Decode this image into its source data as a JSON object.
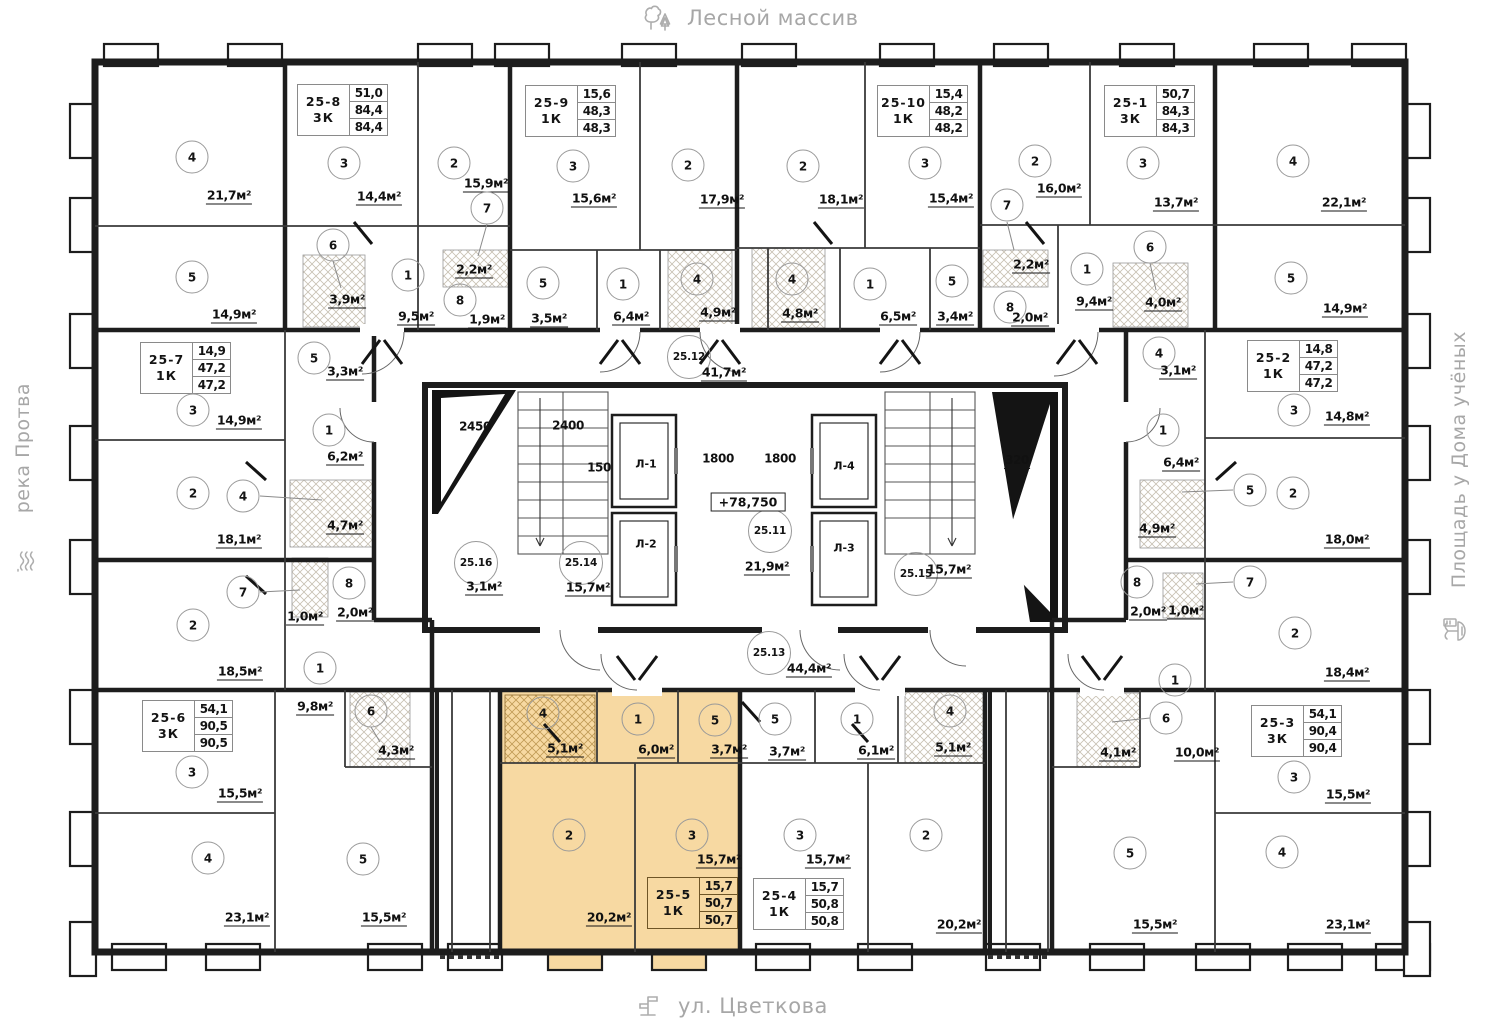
{
  "surroundings": {
    "top": {
      "label": "Лесной массив",
      "icon": "trees-icon"
    },
    "bottom": {
      "label": "ул. Цветкова",
      "icon": "street-sign-icon"
    },
    "left": {
      "label": "река Протва",
      "icon": "river-waves-icon"
    },
    "right": {
      "label": "Площадь у Дома учёных",
      "icon": "fountain-icon"
    }
  },
  "colors": {
    "highlight": "#f7d9a2",
    "wall": "#1d1d1d",
    "decor_text": "#a7a7a7"
  },
  "units": [
    {
      "id": "25-8",
      "type": "3К",
      "vals": [
        "51,0",
        "84,4",
        "84,4"
      ],
      "box": [
        297,
        84
      ],
      "rooms": [
        {
          "n": "4",
          "c": [
            192,
            157
          ],
          "a": "21,7м²",
          "ap": [
            229,
            196
          ]
        },
        {
          "n": "3",
          "c": [
            344,
            163
          ],
          "a": "14,4м²",
          "ap": [
            379,
            197
          ]
        },
        {
          "n": "2",
          "c": [
            454,
            163
          ],
          "a": "15,9м²",
          "ap": [
            486,
            184
          ]
        },
        {
          "n": "7",
          "c": [
            487,
            208
          ],
          "a": "2,2м²",
          "ap": [
            474,
            270
          ],
          "leader": [
            487,
            224,
            478,
            256
          ]
        },
        {
          "n": "6",
          "c": [
            333,
            245
          ],
          "a": "3,9м²",
          "ap": [
            347,
            300
          ],
          "leader": [
            333,
            261,
            341,
            288
          ]
        },
        {
          "n": "5",
          "c": [
            192,
            277
          ],
          "a": "14,9м²",
          "ap": [
            234,
            315
          ]
        },
        {
          "n": "1",
          "c": [
            408,
            275
          ],
          "a": "9,5м²",
          "ap": [
            416,
            317
          ]
        },
        {
          "n": "8",
          "c": [
            460,
            300
          ],
          "a": "1,9м²",
          "ap": [
            487,
            320
          ]
        }
      ]
    },
    {
      "id": "25-9",
      "type": "1К",
      "vals": [
        "15,6",
        "48,3",
        "48,3"
      ],
      "box": [
        525,
        85
      ],
      "rooms": [
        {
          "n": "3",
          "c": [
            573,
            166
          ],
          "a": "15,6м²",
          "ap": [
            594,
            199
          ]
        },
        {
          "n": "2",
          "c": [
            688,
            165
          ],
          "a": "17,9м²",
          "ap": [
            722,
            200
          ]
        },
        {
          "n": "5",
          "c": [
            543,
            283
          ],
          "a": "3,5м²",
          "ap": [
            549,
            319
          ]
        },
        {
          "n": "1",
          "c": [
            623,
            284
          ],
          "a": "6,4м²",
          "ap": [
            631,
            317
          ]
        },
        {
          "n": "4",
          "c": [
            697,
            279
          ],
          "a": "4,9м²",
          "ap": [
            718,
            313
          ]
        }
      ]
    },
    {
      "id": "25-10",
      "type": "1К",
      "vals": [
        "15,4",
        "48,2",
        "48,2"
      ],
      "box": [
        877,
        85
      ],
      "rooms": [
        {
          "n": "2",
          "c": [
            803,
            166
          ],
          "a": "18,1м²",
          "ap": [
            841,
            200
          ]
        },
        {
          "n": "3",
          "c": [
            925,
            163
          ],
          "a": "15,4м²",
          "ap": [
            951,
            199
          ]
        },
        {
          "n": "4",
          "c": [
            792,
            279
          ],
          "a": "4,8м²",
          "ap": [
            800,
            314
          ]
        },
        {
          "n": "1",
          "c": [
            870,
            284
          ],
          "a": "6,5м²",
          "ap": [
            898,
            317
          ]
        },
        {
          "n": "5",
          "c": [
            952,
            281
          ],
          "a": "3,4м²",
          "ap": [
            955,
            317
          ]
        }
      ]
    },
    {
      "id": "25-1",
      "type": "3К",
      "vals": [
        "50,7",
        "84,3",
        "84,3"
      ],
      "box": [
        1104,
        85
      ],
      "rooms": [
        {
          "n": "2",
          "c": [
            1035,
            161
          ],
          "a": "16,0м²",
          "ap": [
            1059,
            189
          ]
        },
        {
          "n": "3",
          "c": [
            1143,
            163
          ],
          "a": "13,7м²",
          "ap": [
            1176,
            203
          ]
        },
        {
          "n": "4",
          "c": [
            1293,
            161
          ],
          "a": "22,1м²",
          "ap": [
            1344,
            203
          ]
        },
        {
          "n": "7",
          "c": [
            1007,
            205
          ],
          "a": "2,2м²",
          "ap": [
            1031,
            265
          ],
          "leader": [
            1007,
            222,
            1014,
            250
          ]
        },
        {
          "n": "6",
          "c": [
            1150,
            247
          ],
          "a": "4,0м²",
          "ap": [
            1163,
            303
          ],
          "leader": [
            1150,
            263,
            1156,
            290
          ]
        },
        {
          "n": "1",
          "c": [
            1087,
            269
          ],
          "a": "9,4м²",
          "ap": [
            1094,
            302
          ]
        },
        {
          "n": "8",
          "c": [
            1010,
            307
          ],
          "a": "2,0м²",
          "ap": [
            1030,
            318
          ]
        },
        {
          "n": "5",
          "c": [
            1291,
            278
          ],
          "a": "14,9м²",
          "ap": [
            1345,
            309
          ]
        }
      ]
    },
    {
      "id": "25-7",
      "type": "1К",
      "vals": [
        "14,9",
        "47,2",
        "47,2"
      ],
      "box": [
        140,
        342
      ],
      "rooms": [
        {
          "n": "3",
          "c": [
            193,
            410
          ],
          "a": "14,9м²",
          "ap": [
            239,
            421
          ]
        },
        {
          "n": "5",
          "c": [
            314,
            358
          ],
          "a": "3,3м²",
          "ap": [
            345,
            372
          ]
        },
        {
          "n": "1",
          "c": [
            329,
            430
          ],
          "a": "6,2м²",
          "ap": [
            345,
            457
          ]
        },
        {
          "n": "2",
          "c": [
            193,
            493
          ],
          "a": "18,1м²",
          "ap": [
            239,
            540
          ]
        },
        {
          "n": "4",
          "c": [
            243,
            496
          ],
          "a": "4,7м²",
          "ap": [
            345,
            526
          ],
          "leader": [
            260,
            496,
            322,
            500
          ]
        }
      ]
    },
    {
      "id": "25-6",
      "type": "3К",
      "vals": [
        "54,1",
        "90,5",
        "90,5"
      ],
      "box": [
        142,
        700
      ],
      "rooms": [
        {
          "n": "7",
          "c": [
            243,
            592
          ],
          "a": "1,0м²",
          "ap": [
            305,
            617
          ],
          "leader": [
            260,
            592,
            300,
            590
          ]
        },
        {
          "n": "8",
          "c": [
            349,
            583
          ],
          "a": "2,0м²",
          "ap": [
            355,
            613
          ]
        },
        {
          "n": "2",
          "c": [
            193,
            625
          ],
          "a": "18,5м²",
          "ap": [
            240,
            672
          ]
        },
        {
          "n": "1",
          "c": [
            320,
            668
          ],
          "a": "9,8м²",
          "ap": [
            315,
            707
          ]
        },
        {
          "n": "6",
          "c": [
            371,
            711
          ],
          "a": "4,3м²",
          "ap": [
            396,
            751
          ],
          "leader": [
            371,
            727,
            380,
            742
          ]
        },
        {
          "n": "3",
          "c": [
            192,
            772
          ],
          "a": "15,5м²",
          "ap": [
            240,
            794
          ]
        },
        {
          "n": "4",
          "c": [
            208,
            858
          ],
          "a": "23,1м²",
          "ap": [
            247,
            918
          ]
        },
        {
          "n": "5",
          "c": [
            363,
            859
          ],
          "a": "15,5м²",
          "ap": [
            384,
            918
          ]
        }
      ]
    },
    {
      "id": "25-2",
      "type": "1К",
      "vals": [
        "14,8",
        "47,2",
        "47,2"
      ],
      "box": [
        1247,
        340
      ],
      "rooms": [
        {
          "n": "4",
          "c": [
            1159,
            353
          ],
          "a": "3,1м²",
          "ap": [
            1178,
            371
          ]
        },
        {
          "n": "3",
          "c": [
            1294,
            410
          ],
          "a": "14,8м²",
          "ap": [
            1347,
            417
          ]
        },
        {
          "n": "1",
          "c": [
            1163,
            430
          ],
          "a": "6,4м²",
          "ap": [
            1181,
            463
          ]
        },
        {
          "n": "5",
          "c": [
            1250,
            490
          ],
          "a": "4,9м²",
          "ap": [
            1157,
            529
          ],
          "leader": [
            1233,
            490,
            1182,
            492
          ]
        },
        {
          "n": "2",
          "c": [
            1293,
            493
          ],
          "a": "18,0м²",
          "ap": [
            1347,
            540
          ]
        },
        {
          "n": "7",
          "c": [
            1250,
            582
          ],
          "a": "1,0м²",
          "ap": [
            1186,
            611
          ],
          "leader": [
            1233,
            582,
            1196,
            584
          ]
        },
        {
          "n": "8",
          "c": [
            1137,
            582
          ],
          "a": "2,0м²",
          "ap": [
            1148,
            612
          ]
        }
      ]
    },
    {
      "id": "25-3",
      "type": "3К",
      "vals": [
        "54,1",
        "90,4",
        "90,4"
      ],
      "box": [
        1251,
        705
      ],
      "rooms": [
        {
          "n": "2",
          "c": [
            1295,
            633
          ],
          "a": "18,4м²",
          "ap": [
            1347,
            673
          ]
        },
        {
          "n": "1",
          "c": [
            1175,
            680
          ],
          "a": "10,0м²",
          "ap": [
            1197,
            753
          ]
        },
        {
          "n": "6",
          "c": [
            1166,
            718
          ],
          "a": "4,1м²",
          "ap": [
            1118,
            753
          ],
          "leader": [
            1150,
            718,
            1112,
            722
          ]
        },
        {
          "n": "3",
          "c": [
            1294,
            777
          ],
          "a": "15,5м²",
          "ap": [
            1348,
            795
          ]
        },
        {
          "n": "5",
          "c": [
            1130,
            853
          ],
          "a": "15,5м²",
          "ap": [
            1155,
            925
          ]
        },
        {
          "n": "4",
          "c": [
            1282,
            852
          ],
          "a": "23,1м²",
          "ap": [
            1348,
            925
          ]
        }
      ]
    },
    {
      "id": "25-5",
      "type": "1К",
      "vals": [
        "15,7",
        "50,7",
        "50,7"
      ],
      "box": [
        647,
        877
      ],
      "highlight": true,
      "rooms": [
        {
          "n": "4",
          "c": [
            543,
            713
          ],
          "a": "5,1м²",
          "ap": [
            565,
            749
          ]
        },
        {
          "n": "1",
          "c": [
            638,
            719
          ],
          "a": "6,0м²",
          "ap": [
            656,
            750
          ]
        },
        {
          "n": "5",
          "c": [
            715,
            720
          ],
          "a": "3,7м²",
          "ap": [
            729,
            750
          ]
        },
        {
          "n": "2",
          "c": [
            569,
            835
          ],
          "a": "20,2м²",
          "ap": [
            609,
            918
          ]
        },
        {
          "n": "3",
          "c": [
            692,
            835
          ],
          "a": "15,7м²",
          "ap": [
            719,
            860
          ]
        }
      ]
    },
    {
      "id": "25-4",
      "type": "1К",
      "vals": [
        "15,7",
        "50,8",
        "50,8"
      ],
      "box": [
        753,
        878
      ],
      "rooms": [
        {
          "n": "5",
          "c": [
            775,
            719
          ],
          "a": "3,7м²",
          "ap": [
            787,
            752
          ]
        },
        {
          "n": "1",
          "c": [
            857,
            719
          ],
          "a": "6,1м²",
          "ap": [
            876,
            751
          ]
        },
        {
          "n": "4",
          "c": [
            950,
            711
          ],
          "a": "5,1м²",
          "ap": [
            953,
            748
          ]
        },
        {
          "n": "3",
          "c": [
            800,
            835
          ],
          "a": "15,7м²",
          "ap": [
            828,
            860
          ]
        },
        {
          "n": "2",
          "c": [
            926,
            835
          ],
          "a": "20,2м²",
          "ap": [
            959,
            925
          ]
        }
      ]
    }
  ],
  "core": {
    "zones": [
      {
        "id": "25.12",
        "c": [
          689,
          357
        ],
        "a": "41,7м²",
        "ap": [
          724,
          373
        ]
      },
      {
        "id": "25.16",
        "c": [
          476,
          563
        ],
        "a": "3,1м²",
        "ap": [
          484,
          587
        ]
      },
      {
        "id": "25.14",
        "c": [
          581,
          563
        ],
        "a": "15,7м²",
        "ap": [
          588,
          588
        ]
      },
      {
        "id": "25.11",
        "c": [
          770,
          531
        ],
        "a": "21,9м²",
        "ap": [
          767,
          567
        ]
      },
      {
        "id": "25.15",
        "c": [
          916,
          574
        ],
        "a": "15,7м²",
        "ap": [
          949,
          570
        ]
      },
      {
        "id": "25.13",
        "c": [
          769,
          653
        ],
        "a": "44,4м²",
        "ap": [
          809,
          669
        ]
      }
    ],
    "dims": [
      {
        "t": "2450",
        "p": [
          475,
          427
        ]
      },
      {
        "t": "2400",
        "p": [
          568,
          426
        ]
      },
      {
        "t": "150",
        "p": [
          599,
          468
        ]
      },
      {
        "t": "1800",
        "p": [
          718,
          459
        ]
      },
      {
        "t": "1800",
        "p": [
          780,
          459
        ]
      },
      {
        "t": "320",
        "p": [
          1017,
          461
        ],
        "u": true
      }
    ],
    "elevation": {
      "t": "+78,750",
      "p": [
        748,
        502
      ]
    },
    "elevators": [
      {
        "t": "Л-1",
        "p": [
          646,
          464
        ]
      },
      {
        "t": "Л-2",
        "p": [
          646,
          544
        ]
      },
      {
        "t": "Л-4",
        "p": [
          844,
          466
        ]
      },
      {
        "t": "Л-3",
        "p": [
          844,
          548
        ]
      }
    ]
  }
}
